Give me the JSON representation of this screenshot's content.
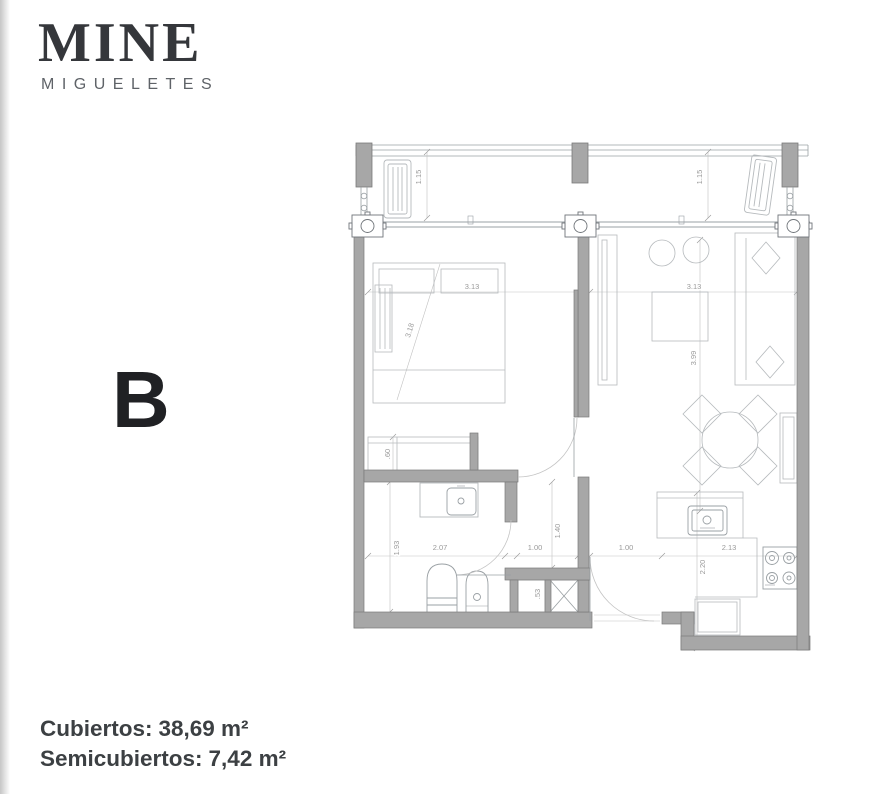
{
  "page": {
    "background": "#ffffff",
    "edge_shadow": "#c6c6c6"
  },
  "logo": {
    "title": "MINE",
    "subtitle": "MIGUELETES"
  },
  "unit": {
    "label": "B"
  },
  "areas": {
    "covered": {
      "label": "Cubiertos:",
      "value": "38,69 m²"
    },
    "semicovered": {
      "label": "Semicubiertos:",
      "value": "7,42 m²"
    }
  },
  "plan": {
    "colors": {
      "wall_fill": "#a7a7a7",
      "wall_stroke": "#7a7a7a",
      "furniture_line": "#b6babd",
      "fixture_line": "#9aa0a4",
      "dim_line": "#c2c2c2",
      "dim_text": "#9a9a9a"
    },
    "dims": {
      "balcony_left": "1.15",
      "balcony_right": "1.15",
      "bedroom_width": "3.13",
      "living_width": "3.13",
      "bedroom_diagonal": "3.18",
      "living_depth": "3.99",
      "closet_depth": ".60",
      "bath_height": "1.93",
      "bath_width": "2.07",
      "hall_width": "1.00",
      "hall_height": "1.40",
      "entry_width": "1.00",
      "shaft_width": ".53",
      "kitchen_width": "2.13",
      "kitchen_height": "2.20"
    }
  }
}
